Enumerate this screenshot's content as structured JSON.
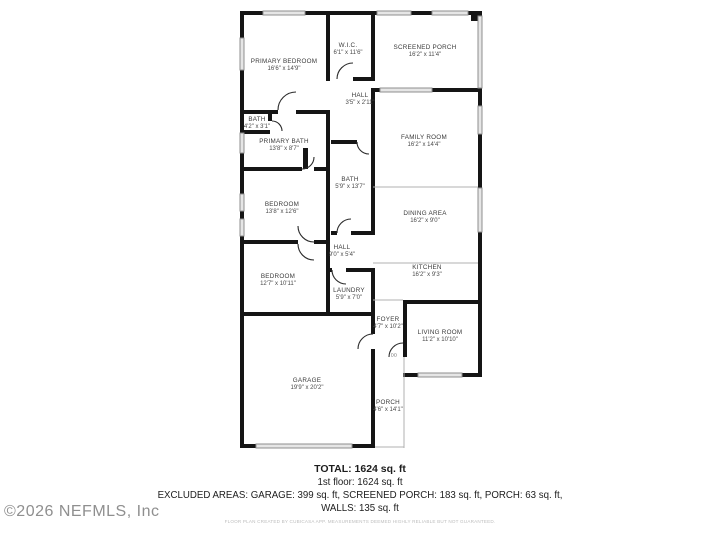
{
  "rooms": [
    {
      "name": "PRIMARY BEDROOM",
      "dims": "16'6\" x 14'9\""
    },
    {
      "name": "W.I.C.",
      "dims": "6'1\" x 11'6\""
    },
    {
      "name": "SCREENED PORCH",
      "dims": "16'2\" x 11'4\""
    },
    {
      "name": "HALL",
      "dims": "3'5\" x 2'11\""
    },
    {
      "name": "BATH",
      "dims": "4'2\" x 3'1\""
    },
    {
      "name": "PRIMARY BATH",
      "dims": "13'8\" x 8'7\""
    },
    {
      "name": "FAMILY ROOM",
      "dims": "16'2\" x 14'4\""
    },
    {
      "name": "BATH",
      "dims": "5'9\" x 13'7\""
    },
    {
      "name": "BEDROOM",
      "dims": "13'8\" x 12'6\""
    },
    {
      "name": "DINING AREA",
      "dims": "16'2\" x 9'0\""
    },
    {
      "name": "HALL",
      "dims": "9'0\" x 5'4\""
    },
    {
      "name": "KITCHEN",
      "dims": "16'2\" x 9'3\""
    },
    {
      "name": "BEDROOM",
      "dims": "12'7\" x 10'11\""
    },
    {
      "name": "LAUNDRY",
      "dims": "5'9\" x 7'0\""
    },
    {
      "name": "FOYER",
      "dims": "4'7\" x 10'2\""
    },
    {
      "name": "LIVING ROOM",
      "dims": "11'2\" x 10'10\""
    },
    {
      "name": "GARAGE",
      "dims": "19'9\" x 20'2\""
    },
    {
      "name": "PORCH",
      "dims": "4'6\" x 14'1\""
    }
  ],
  "front_door_marker": "DD",
  "summary": {
    "total": "TOTAL: 1624 sq. ft",
    "first_floor": "1st floor: 1624 sq. ft",
    "excluded_line": "EXCLUDED AREAS: GARAGE: 399 sq. ft, SCREENED PORCH: 183 sq. ft, PORCH: 63 sq. ft,",
    "walls_line": "WALLS: 135 sq. ft",
    "disclaimer": "FLOOR PLAN CREATED BY CUBICASA APP. MEASUREMENTS DEEMED HIGHLY RELIABLE BUT NOT GUARANTEED."
  },
  "watermark": "©2026 NEFMLS, Inc",
  "colors": {
    "wall": "#151515",
    "window_fill": "#e6e6e6",
    "window_stroke": "#8f8f8f",
    "thin_line": "#b0b0b0"
  }
}
